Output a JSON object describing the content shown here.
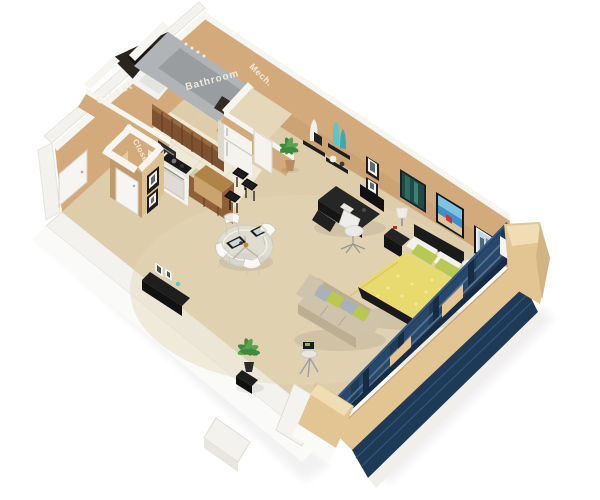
{
  "scene": {
    "type": "3d-floor-plan-render",
    "apartment_type": "studio",
    "rooms": [
      {
        "id": "closet-main",
        "label": "Closet"
      },
      {
        "id": "bathroom",
        "label": "Bathroom"
      },
      {
        "id": "mech",
        "label": "Mech."
      },
      {
        "id": "closet-kitchen",
        "label": "Closet"
      }
    ],
    "colors": {
      "background": "#ffffff",
      "floor_carpet": "#ddcdab",
      "floor_kitchen": "#f0e9d8",
      "wall_tan": "#d2aa7c",
      "wall_tan_light": "#dfc093",
      "wall_tan_dark": "#c2996b",
      "wall_rim_white": "#f7f5ef",
      "outer_white": "#f3f2ee",
      "exterior_tan": "#e3c493",
      "window_navy": "#1e3a56",
      "window_navy_dark": "#152c44",
      "window_glass": "#27486a",
      "window_mullion": "#54708e",
      "wood_dark": "#7e512f",
      "wood_mid": "#8f5f38",
      "wood_light": "#b08449",
      "counter_tan": "#d8c9a8",
      "appliance_white": "#f4f3f0",
      "appliance_shadow": "#dcd9d2",
      "furniture_black": "#1d1d1d",
      "bed_yellow": "#e9da70",
      "bed_yellow_light": "#f3e893",
      "pillow_green": "#b7c94e",
      "pillow_white": "#f2f1ec",
      "sofa_beige": "#cfc3ab",
      "sofa_beige_dark": "#bcae93",
      "pillow_gray": "#a8b2ba",
      "plant_green": "#3f8a3c",
      "plant_green_light": "#5aa34f",
      "vase_teal": "#5fc4c9",
      "bathroom_gray": "#b0b4b6",
      "bathroom_gray_dark": "#999d9f",
      "tub_white": "#f2f2f0",
      "label_text": "#f5efe2"
    }
  }
}
